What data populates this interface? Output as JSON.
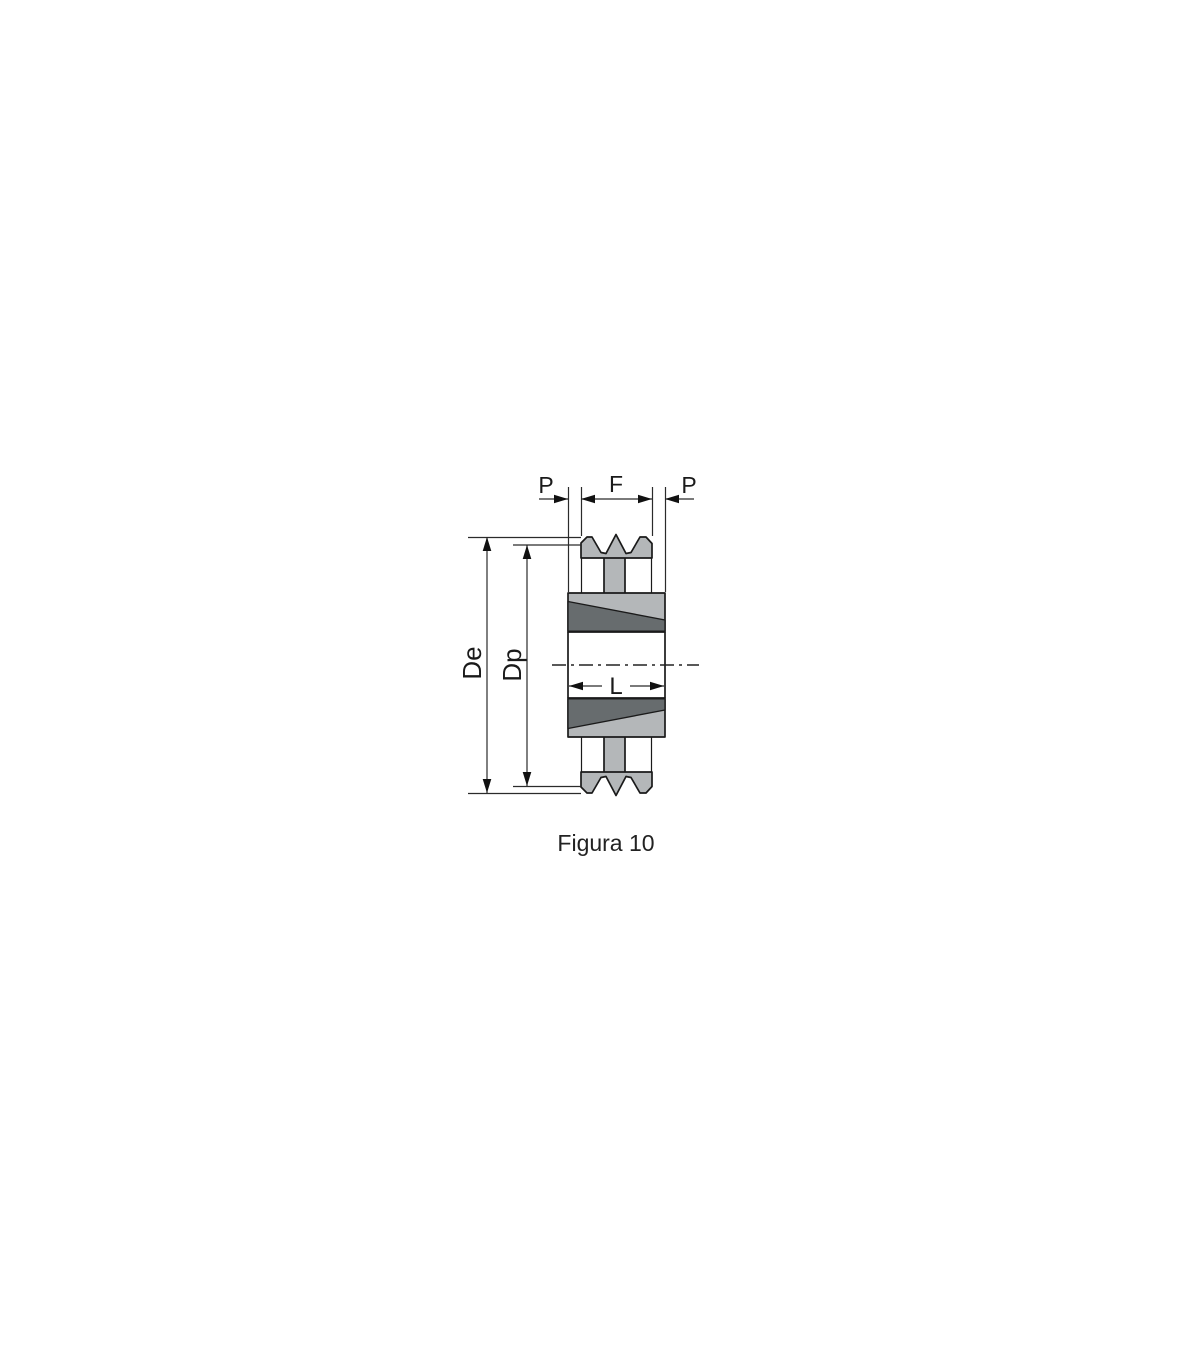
{
  "figure": {
    "caption": "Figura 10",
    "labels": {
      "p_left": "P",
      "f": "F",
      "p_right": "P",
      "de": "De",
      "dp": "Dp",
      "l": "L"
    },
    "colors": {
      "body_light": "#b4b7b9",
      "bushing_dark": "#676c6e",
      "line": "#1a1a1a",
      "dim_line": "#2b2b2b",
      "background": "#ffffff"
    }
  }
}
